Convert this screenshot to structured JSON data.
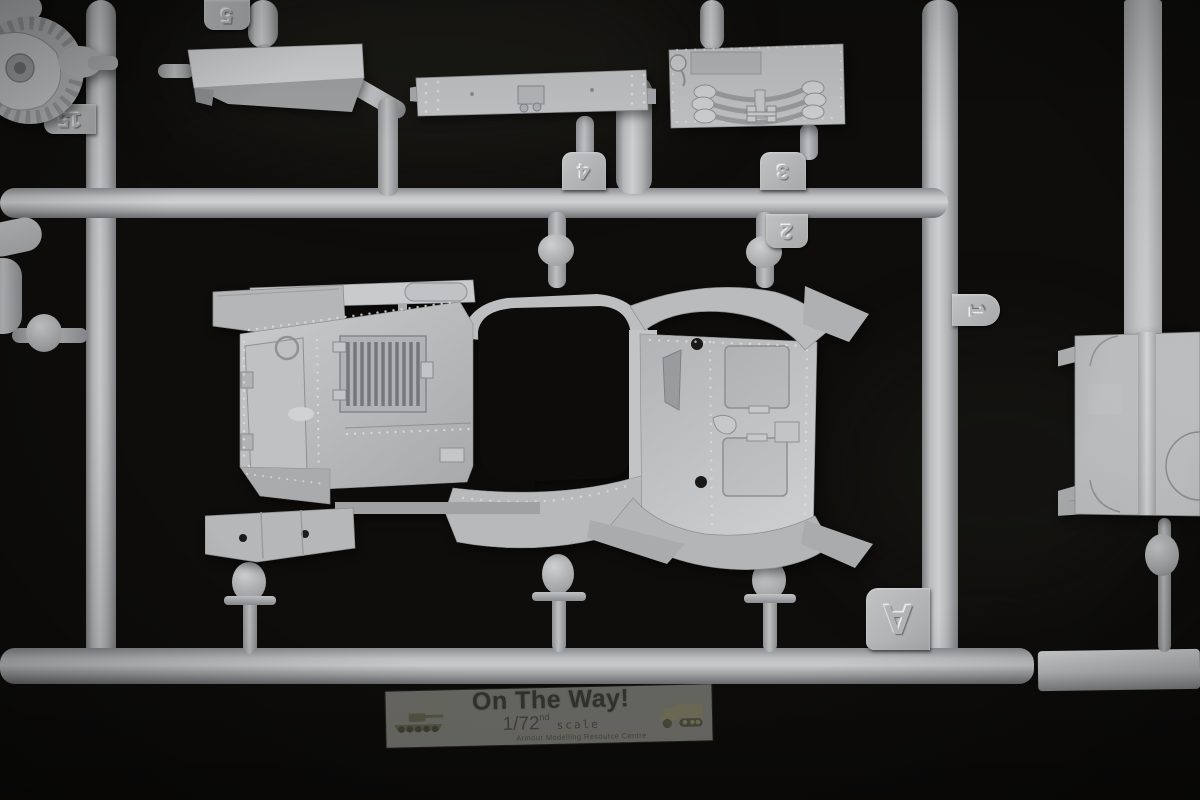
{
  "scene": {
    "description": "Photograph of a grey injection-moulded styrene sprue from a 1/72 scale armoured-car model kit on a black background",
    "sprue_letter": "A",
    "plastic_color_mid": "#b2b4b6",
    "plastic_color_highlight": "#d2d4d6",
    "plastic_color_shadow": "#7c7e80",
    "background_color": "#0e0d0b"
  },
  "tags": {
    "t5": "5",
    "t15": "15",
    "t4": "4",
    "t3": "3",
    "t2": "2",
    "t1": "1",
    "tA": "A"
  },
  "watermark": {
    "title": "On The Way!",
    "scale_main": "1/72",
    "scale_sup": "nd",
    "scale_word": "scale",
    "subtitle": "Armour Modelling Resource Centre",
    "panel_color": "rgba(197,197,188,0.48)",
    "text_color": "#2a2a27"
  }
}
